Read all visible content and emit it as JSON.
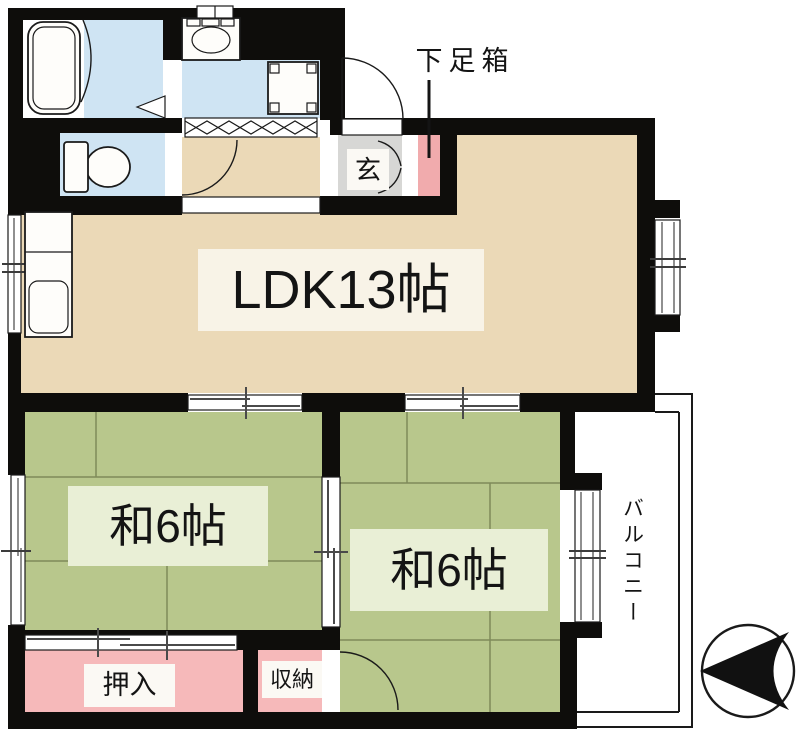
{
  "floor_plan": {
    "rooms": {
      "ldk": {
        "label": "LDK13帖"
      },
      "japanese_room_left": {
        "label": "和6帖"
      },
      "japanese_room_right": {
        "label": "和6帖"
      },
      "closet": {
        "label": "押入"
      },
      "storage": {
        "label": "収納"
      },
      "entrance": {
        "label": "玄"
      },
      "shoe_box": {
        "label": "下足箱"
      },
      "balcony": {
        "label": "バルコニー"
      }
    },
    "fixtures": [
      "bathtub",
      "toilet",
      "vanity-basin",
      "washing-machine-pan",
      "kitchen-sink"
    ],
    "compass": {
      "type": "north-arrow",
      "pointing": "left"
    },
    "colors": {
      "wall": "#0e0d0b",
      "outline": "#1a1a1a",
      "ldk_floor": "#ebd9b7",
      "tatami": "#b8c78c",
      "tatami_line": "#7f8a5a",
      "water_area": "#cfe4f3",
      "closet_pink": "#f6b9ba",
      "shoe_box_pink": "#f1abad",
      "entrance_gray": "#d7d7d5",
      "label_bg_ldk": "#f8f3e7",
      "label_bg_tatami": "#e9efd6",
      "label_bg_white": "#fbf9f4"
    }
  }
}
